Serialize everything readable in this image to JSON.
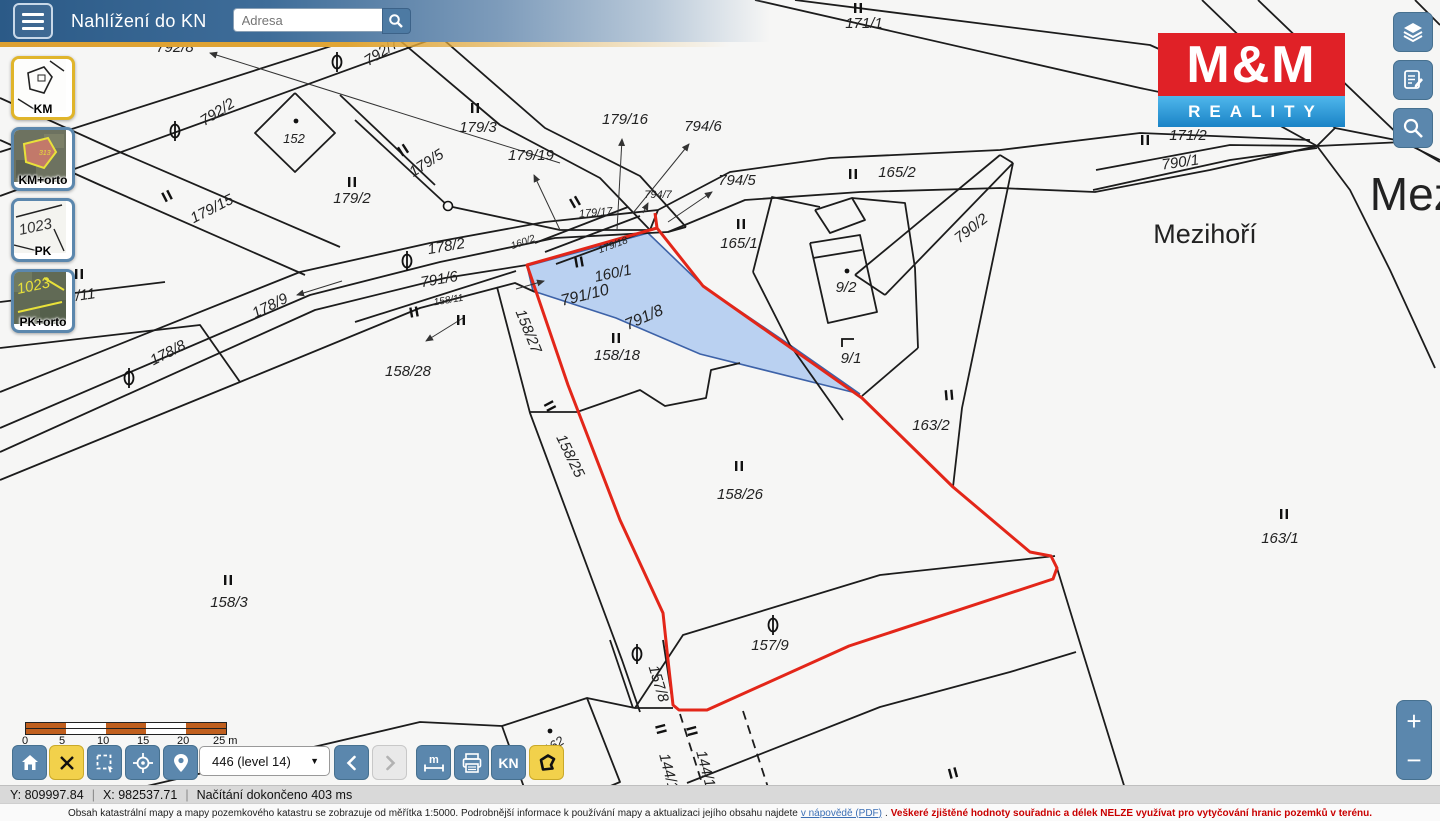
{
  "header": {
    "title": "Nahlížení do KN",
    "search_placeholder": "Adresa"
  },
  "layer_buttons": [
    {
      "id": "km",
      "label": "KM",
      "active": true
    },
    {
      "id": "km-orto",
      "label": "KM+orto",
      "active": false
    },
    {
      "id": "pk",
      "label": "PK",
      "active": false
    },
    {
      "id": "pk-orto",
      "label": "PK+orto",
      "active": false
    }
  ],
  "logo": {
    "line1": "M&M",
    "line2": "REALITY"
  },
  "toolbar": {
    "scale_ticks": [
      "0",
      "5",
      "10",
      "15",
      "20",
      "25 m"
    ],
    "level_select": "446 (level 14)",
    "kn_label": "KN",
    "measure_label": "m"
  },
  "zoom_control": {
    "plus": "+",
    "minus": "−"
  },
  "statusbar": {
    "y": "Y: 809997.84",
    "x": "X: 982537.71",
    "status": "Načítání dokončeno 403 ms"
  },
  "footer": {
    "text1": "Obsah katastrální mapy a mapy pozemkového katastru se zobrazuje od měřítka 1:5000. Podrobnější informace k používání mapy a aktualizaci jejího obsahu najdete",
    "link": "v nápovědě (PDF)",
    "dot": ".",
    "warning": "Veškeré zjištěné hodnoty souřadnic a délek NELZE využívat pro vytyčování hranic pozemků v terénu."
  },
  "map": {
    "colors": {
      "line": "#1c1c1c",
      "red": "#e32619",
      "blue_fill": "#a9c7ef",
      "blue_stroke": "#3d62a8",
      "label": "#222222"
    },
    "labels": [
      {
        "t": "171/1",
        "x": 864,
        "y": 28
      },
      {
        "t": "4/2",
        "x": 391,
        "y": 9,
        "r": -33,
        "s": 12
      },
      {
        "t": "792/8",
        "x": 175,
        "y": 52
      },
      {
        "t": "792/7",
        "x": 384,
        "y": 56,
        "r": -33
      },
      {
        "t": "792/2",
        "x": 220,
        "y": 116,
        "r": -33
      },
      {
        "t": "152",
        "x": 294,
        "y": 143,
        "s": 13
      },
      {
        "t": "179/3",
        "x": 478,
        "y": 132
      },
      {
        "t": "179/16",
        "x": 625,
        "y": 124
      },
      {
        "t": "794/6",
        "x": 703,
        "y": 131
      },
      {
        "t": "171/2",
        "x": 1188,
        "y": 140
      },
      {
        "t": "790/1",
        "x": 1181,
        "y": 167,
        "r": -8
      },
      {
        "t": "179/19",
        "x": 531,
        "y": 160
      },
      {
        "t": "179/5",
        "x": 429,
        "y": 167,
        "r": -33
      },
      {
        "t": "794/5",
        "x": 737,
        "y": 185
      },
      {
        "t": "165/2",
        "x": 897,
        "y": 177
      },
      {
        "t": "179/2",
        "x": 352,
        "y": 203
      },
      {
        "t": "179/15",
        "x": 214,
        "y": 213,
        "r": -27
      },
      {
        "t": "794/7",
        "x": 658,
        "y": 198,
        "s": 11
      },
      {
        "t": "179/17",
        "x": 596,
        "y": 216,
        "s": 11,
        "r": -5
      },
      {
        "t": "160/2",
        "x": 524,
        "y": 245,
        "s": 10,
        "r": -20
      },
      {
        "t": "179/18",
        "x": 614,
        "y": 248,
        "s": 10,
        "r": -20
      },
      {
        "t": "165/1",
        "x": 739,
        "y": 248
      },
      {
        "t": "178/2",
        "x": 447,
        "y": 251,
        "r": -10
      },
      {
        "t": "160/1",
        "x": 614,
        "y": 278,
        "r": -12
      },
      {
        "t": "791/6",
        "x": 440,
        "y": 284,
        "r": -10
      },
      {
        "t": "790/2",
        "x": 974,
        "y": 232,
        "r": -38
      },
      {
        "t": "Mezihoří",
        "x": 1205,
        "y": 243,
        "s": 27,
        "plain": true
      },
      {
        "t": "Mezihoří",
        "x": 1458,
        "y": 210,
        "s": 46,
        "plain": true
      },
      {
        "t": "9/2",
        "x": 846,
        "y": 292
      },
      {
        "t": "158/11",
        "x": 449,
        "y": 303,
        "s": 10,
        "r": -9
      },
      {
        "t": "178/9",
        "x": 272,
        "y": 310,
        "r": -26
      },
      {
        "t": "791/10",
        "x": 586,
        "y": 300,
        "r": -14,
        "s": 16
      },
      {
        "t": "791/8",
        "x": 646,
        "y": 322,
        "r": -24,
        "s": 16
      },
      {
        "t": "158/27",
        "x": 524,
        "y": 333,
        "r": 68
      },
      {
        "t": "158/18",
        "x": 617,
        "y": 360
      },
      {
        "t": "9/1",
        "x": 851,
        "y": 363
      },
      {
        "t": "178/8",
        "x": 170,
        "y": 357,
        "r": -27
      },
      {
        "t": "158/28",
        "x": 408,
        "y": 376
      },
      {
        "t": "9/11",
        "x": 82,
        "y": 300,
        "r": -8
      },
      {
        "t": "158/3",
        "x": 229,
        "y": 607
      },
      {
        "t": "163/2",
        "x": 931,
        "y": 430
      },
      {
        "t": "158/25",
        "x": 566,
        "y": 458,
        "r": 64
      },
      {
        "t": "158/26",
        "x": 740,
        "y": 499
      },
      {
        "t": "163/1",
        "x": 1280,
        "y": 543
      },
      {
        "t": "157/9",
        "x": 770,
        "y": 650
      },
      {
        "t": "157/8",
        "x": 654,
        "y": 685,
        "r": 73
      },
      {
        "t": "162",
        "x": 556,
        "y": 749,
        "r": -33,
        "s": 13
      },
      {
        "t": "144/1",
        "x": 664,
        "y": 773,
        "r": 75
      },
      {
        "t": "144/1",
        "x": 701,
        "y": 770,
        "r": 75
      }
    ],
    "lines": [
      [
        [
          0,
          152
        ],
        [
          475,
          0
        ]
      ],
      [
        [
          0,
          196
        ],
        [
          540,
          0
        ]
      ],
      [
        [
          352,
          0
        ],
        [
          500,
          125
        ],
        [
          600,
          178
        ],
        [
          650,
          230
        ]
      ],
      [
        [
          398,
          0
        ],
        [
          545,
          128
        ],
        [
          640,
          176
        ],
        [
          686,
          227
        ]
      ],
      [
        [
          295,
          93
        ],
        [
          335,
          133
        ],
        [
          295,
          172
        ],
        [
          255,
          133
        ],
        [
          295,
          93
        ]
      ],
      [
        [
          0,
          98
        ],
        [
          115,
          150
        ],
        [
          340,
          247
        ]
      ],
      [
        [
          0,
          140
        ],
        [
          100,
          185
        ],
        [
          305,
          275
        ]
      ],
      [
        [
          0,
          392
        ],
        [
          300,
          272
        ],
        [
          430,
          243
        ],
        [
          545,
          222
        ],
        [
          658,
          210
        ]
      ],
      [
        [
          0,
          428
        ],
        [
          310,
          295
        ],
        [
          440,
          262
        ],
        [
          555,
          238
        ],
        [
          668,
          232
        ]
      ],
      [
        [
          0,
          452
        ],
        [
          315,
          310
        ],
        [
          445,
          278
        ],
        [
          527,
          265
        ]
      ],
      [
        [
          0,
          480
        ],
        [
          240,
          382
        ],
        [
          420,
          308
        ],
        [
          515,
          283
        ],
        [
          535,
          292
        ]
      ],
      [
        [
          355,
          322
        ],
        [
          516,
          271
        ]
      ],
      [
        [
          0,
          302
        ],
        [
          165,
          282
        ]
      ],
      [
        [
          0,
          348
        ],
        [
          200,
          325
        ],
        [
          240,
          382
        ]
      ],
      [
        [
          340,
          95
        ],
        [
          435,
          185
        ]
      ],
      [
        [
          355,
          120
        ],
        [
          448,
          206
        ]
      ],
      [
        [
          448,
          206
        ],
        [
          560,
          230
        ],
        [
          650,
          230
        ]
      ],
      [
        [
          535,
          243
        ],
        [
          628,
          207
        ]
      ],
      [
        [
          545,
          252
        ],
        [
          640,
          216
        ]
      ],
      [
        [
          556,
          264
        ],
        [
          652,
          229
        ]
      ],
      [
        [
          650,
          230
        ],
        [
          658,
          210
        ]
      ],
      [
        [
          668,
          232
        ],
        [
          686,
          227
        ]
      ],
      [
        [
          658,
          210
        ],
        [
          730,
          172
        ],
        [
          830,
          158
        ],
        [
          1000,
          150
        ],
        [
          1140,
          133
        ],
        [
          1310,
          140
        ]
      ],
      [
        [
          668,
          232
        ],
        [
          745,
          200
        ],
        [
          860,
          192
        ],
        [
          1000,
          188
        ],
        [
          1095,
          192
        ],
        [
          1210,
          170
        ],
        [
          1317,
          146
        ]
      ],
      [
        [
          1093,
          190
        ],
        [
          1230,
          160
        ],
        [
          1317,
          148
        ]
      ],
      [
        [
          1096,
          170
        ],
        [
          1230,
          145
        ],
        [
          1317,
          146
        ]
      ],
      [
        [
          1317,
          146
        ],
        [
          1350,
          190
        ],
        [
          1390,
          270
        ],
        [
          1435,
          368
        ]
      ],
      [
        [
          1317,
          146
        ],
        [
          1403,
          142
        ],
        [
          1440,
          160
        ]
      ],
      [
        [
          1202,
          0
        ],
        [
          1335,
          128
        ],
        [
          1317,
          146
        ]
      ],
      [
        [
          1258,
          0
        ],
        [
          1406,
          142
        ],
        [
          1440,
          162
        ]
      ],
      [
        [
          1335,
          128
        ],
        [
          1406,
          142
        ]
      ],
      [
        [
          795,
          0
        ],
        [
          1150,
          45
        ],
        [
          1330,
          125
        ]
      ],
      [
        [
          755,
          0
        ],
        [
          1140,
          88
        ],
        [
          1255,
          112
        ],
        [
          1317,
          146
        ]
      ],
      [
        [
          1415,
          0
        ],
        [
          1440,
          25
        ]
      ],
      [
        [
          753,
          272
        ],
        [
          772,
          197
        ],
        [
          820,
          207
        ]
      ],
      [
        [
          815,
          210
        ],
        [
          852,
          198
        ],
        [
          865,
          220
        ],
        [
          830,
          233
        ],
        [
          815,
          210
        ]
      ],
      [
        [
          810,
          243
        ],
        [
          860,
          235
        ],
        [
          877,
          312
        ],
        [
          828,
          323
        ],
        [
          810,
          243
        ]
      ],
      [
        [
          813,
          258
        ],
        [
          862,
          250
        ]
      ],
      [
        [
          852,
          198
        ],
        [
          905,
          203
        ],
        [
          915,
          268
        ],
        [
          918,
          348
        ]
      ],
      [
        [
          918,
          348
        ],
        [
          862,
          396
        ]
      ],
      [
        [
          855,
          275
        ],
        [
          1000,
          155
        ]
      ],
      [
        [
          885,
          295
        ],
        [
          1013,
          163
        ]
      ],
      [
        [
          855,
          275
        ],
        [
          885,
          295
        ]
      ],
      [
        [
          1000,
          155
        ],
        [
          1013,
          163
        ]
      ],
      [
        [
          1013,
          163
        ],
        [
          962,
          408
        ],
        [
          953,
          487
        ]
      ],
      [
        [
          753,
          272
        ],
        [
          790,
          345
        ],
        [
          843,
          420
        ]
      ],
      [
        [
          497,
          287
        ],
        [
          530,
          413
        ],
        [
          622,
          660
        ],
        [
          640,
          712
        ]
      ],
      [
        [
          530,
          412
        ],
        [
          577,
          412
        ],
        [
          640,
          390
        ],
        [
          665,
          406
        ],
        [
          706,
          398
        ],
        [
          711,
          370
        ],
        [
          740,
          363
        ]
      ],
      [
        [
          1055,
          556
        ],
        [
          880,
          575
        ],
        [
          683,
          635
        ],
        [
          635,
          708
        ],
        [
          587,
          698
        ]
      ],
      [
        [
          635,
          708
        ],
        [
          673,
          708
        ]
      ],
      [
        [
          687,
          783
        ],
        [
          880,
          707
        ],
        [
          1010,
          672
        ],
        [
          1076,
          652
        ]
      ],
      [
        [
          1057,
          568
        ],
        [
          1083,
          653
        ],
        [
          1135,
          821
        ]
      ],
      [
        [
          130,
          790
        ],
        [
          420,
          722
        ],
        [
          502,
          726
        ]
      ],
      [
        [
          502,
          726
        ],
        [
          587,
          698
        ],
        [
          620,
          782
        ],
        [
          535,
          818
        ],
        [
          502,
          726
        ]
      ],
      [
        [
          610,
          640
        ],
        [
          633,
          708
        ]
      ],
      [
        [
          663,
          640
        ],
        [
          673,
          705
        ]
      ]
    ],
    "dashed": [
      [
        [
          680,
          714
        ],
        [
          714,
          821
        ]
      ],
      [
        [
          743,
          711
        ],
        [
          779,
          821
        ]
      ]
    ],
    "red_path": [
      [
        655,
        213
      ],
      [
        657,
        228
      ],
      [
        703,
        286
      ],
      [
        862,
        398
      ],
      [
        953,
        487
      ],
      [
        1030,
        552
      ],
      [
        1051,
        556
      ],
      [
        1057,
        568
      ],
      [
        1053,
        579
      ],
      [
        849,
        646
      ],
      [
        707,
        710
      ],
      [
        679,
        710
      ],
      [
        673,
        705
      ],
      [
        668,
        660
      ],
      [
        663,
        613
      ],
      [
        620,
        520
      ],
      [
        568,
        385
      ],
      [
        527,
        265
      ],
      [
        657,
        228
      ]
    ],
    "blue_parcel": [
      [
        527,
        266
      ],
      [
        648,
        233
      ],
      [
        703,
        286
      ],
      [
        790,
        345
      ],
      [
        860,
        394
      ],
      [
        700,
        354
      ],
      [
        616,
        318
      ],
      [
        533,
        291
      ]
    ],
    "arrows": [
      [
        560,
        163,
        210,
        53
      ],
      [
        560,
        230,
        534,
        175
      ],
      [
        617,
        230,
        622,
        139
      ],
      [
        633,
        213,
        689,
        144
      ],
      [
        668,
        222,
        712,
        192
      ],
      [
        643,
        213,
        648,
        203
      ],
      [
        342,
        281,
        297,
        295
      ],
      [
        463,
        318,
        426,
        341
      ],
      [
        516,
        289,
        544,
        281
      ]
    ],
    "marks": [
      [
        858,
        8,
        0
      ],
      [
        475,
        108,
        0
      ],
      [
        403,
        150,
        -33
      ],
      [
        167,
        196,
        -27
      ],
      [
        352,
        182,
        0
      ],
      [
        741,
        224,
        0
      ],
      [
        853,
        174,
        0
      ],
      [
        1145,
        140,
        0
      ],
      [
        575,
        202,
        -30
      ],
      [
        579,
        262,
        -10
      ],
      [
        616,
        338,
        0
      ],
      [
        461,
        320,
        0
      ],
      [
        414,
        312,
        -10
      ],
      [
        949,
        395,
        -5
      ],
      [
        1284,
        514,
        0
      ],
      [
        228,
        580,
        0
      ],
      [
        739,
        466,
        0
      ],
      [
        550,
        406,
        62
      ],
      [
        661,
        729,
        75
      ],
      [
        692,
        731,
        75
      ],
      [
        953,
        773,
        -15
      ],
      [
        79,
        274,
        0
      ]
    ],
    "theta": [
      [
        337,
        62
      ],
      [
        175,
        131
      ],
      [
        407,
        261
      ],
      [
        129,
        378
      ],
      [
        773,
        625
      ],
      [
        637,
        654
      ]
    ],
    "dots": [
      [
        296,
        121
      ],
      [
        847,
        271
      ],
      [
        550,
        731
      ]
    ],
    "circles": [
      [
        448,
        206
      ]
    ],
    "corner_symbol": [
      848,
      342
    ]
  }
}
